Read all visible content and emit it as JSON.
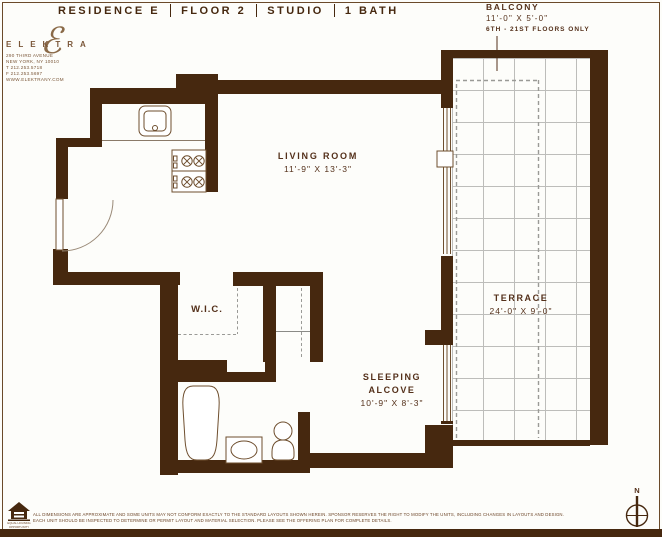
{
  "header": {
    "title_parts": [
      "RESIDENCE E",
      "FLOOR 2",
      "STUDIO",
      "1 BATH"
    ]
  },
  "logo": {
    "brand": "ELEKTRA",
    "script_letter": "ℰ",
    "address_lines": [
      "290 THIRD AVENUE",
      "NEW YORK, NY 10010",
      "T 212.253.5718",
      "F 212.253.5697",
      "WWW.ELEKTRANY.COM"
    ]
  },
  "balcony_note": {
    "title": "BALCONY",
    "dims": "11'-0\" X 5'-0\"",
    "floors": "6TH - 21ST FLOORS ONLY"
  },
  "rooms": {
    "living_room": {
      "name": "LIVING ROOM",
      "dims": "11'-9\" X 13'-3\""
    },
    "terrace": {
      "name": "TERRACE",
      "dims": "24'-0\" X 9'-0\""
    },
    "wic": {
      "name": "W.I.C."
    },
    "sleeping_alcove": {
      "line1": "SLEEPING",
      "line2": "ALCOVE",
      "dims": "10'-9\" X 8'-3\""
    }
  },
  "compass": {
    "north": "N"
  },
  "footer": {
    "disclaimer_line1": "ALL DIMENSIONS ARE APPROXIMATE AND SOME UNITS MAY NOT CONFORM EXACTLY TO THE STANDARD LAYOUTS SHOWN HEREIN.  SPONSOR RESERVES THE RIGHT TO MODIFY THE UNITS, INCLUDING CHANGES IN LAYOUTS AND DESIGN.",
    "disclaimer_line2": "EACH UNIT SHOULD BE INSPECTED TO DETERMINE OR PERMIT LAYOUT AND MATERIAL SELECTION.  PLEASE SEE THE OFFERING PLAN FOR COMPLETE DETAILS.",
    "equal_housing": "EQUAL HOUSING OPPORTUNITY"
  },
  "colors": {
    "wall": "#46280f",
    "text": "#54301a",
    "fixture_stroke": "#6e4e2e",
    "grid": "#bdbdba",
    "dash": "#9a9a96"
  }
}
